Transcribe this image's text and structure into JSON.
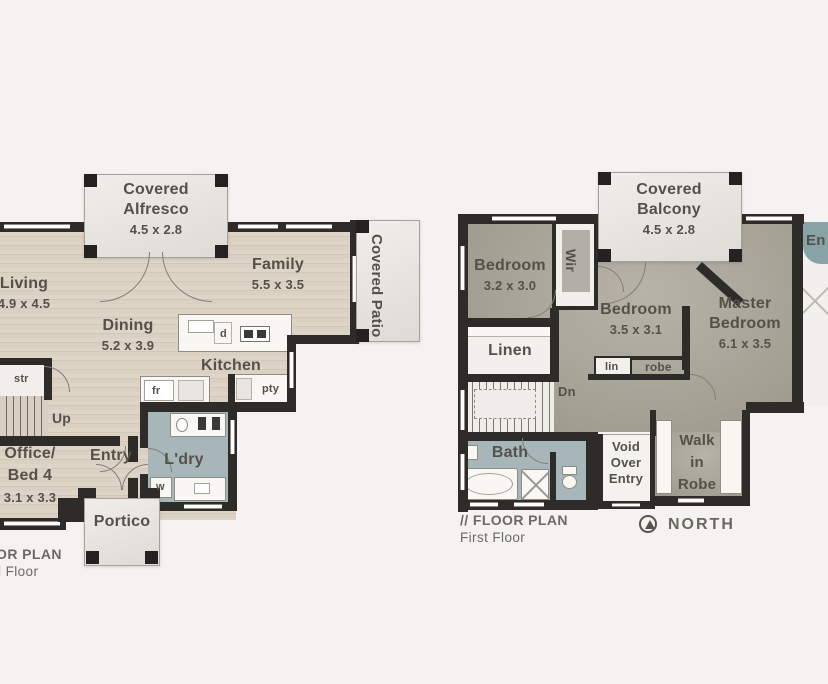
{
  "colors": {
    "background": "#f5f3f1",
    "wood_floor": "#d9cec1",
    "upper_floor": "#a5a195",
    "wet_area": "#a7b7b9",
    "walls": "#2d2c29",
    "covered_area": "#e9e7e2",
    "label_text": "#55514a"
  },
  "ground_floor": {
    "annotation": {
      "line1": "// FLOOR PLAN",
      "line2": "Ground Floor"
    },
    "alfresco": {
      "line1": "Covered",
      "line2": "Alfresco",
      "dims": "4.5 x 2.8"
    },
    "patio": {
      "label": "Covered Patio"
    },
    "living": {
      "name": "Living",
      "dims": "4.9 x 4.5"
    },
    "dining": {
      "name": "Dining",
      "dims": "5.2 x 3.9"
    },
    "family": {
      "name": "Family",
      "dims": "5.5 x 3.5"
    },
    "kitchen": {
      "name": "Kitchen",
      "dishwasher": "d",
      "fridge": "fr",
      "pantry": "pty"
    },
    "stairs": {
      "up": "Up",
      "store": "str"
    },
    "office": {
      "line1": "Office/",
      "line2": "Bed 4",
      "dims": "3.1 x 3.3"
    },
    "entry": {
      "name": "Entry"
    },
    "laundry": {
      "name": "L'dry",
      "washer": "w"
    },
    "portico": {
      "name": "Portico"
    }
  },
  "first_floor": {
    "annotation": {
      "line1": "// FLOOR PLAN",
      "line2": "First Floor"
    },
    "north_label": "NORTH",
    "balcony": {
      "line1": "Covered",
      "line2": "Balcony",
      "dims": "4.5 x 2.8"
    },
    "bedroom2": {
      "name": "Bedroom",
      "dims": "3.2 x 3.0"
    },
    "bedroom3": {
      "name": "Bedroom",
      "dims": "3.5 x 3.1"
    },
    "master": {
      "line1": "Master",
      "line2": "Bedroom",
      "dims": "6.1 x 3.5"
    },
    "wir": {
      "name": "Wir"
    },
    "linen": {
      "name": "Linen"
    },
    "stairs": {
      "dn": "Dn"
    },
    "lin": "lin",
    "robe": "robe",
    "bath": {
      "name": "Bath"
    },
    "void": {
      "line1": "Void",
      "line2": "Over",
      "line3": "Entry"
    },
    "walk_in_robe": {
      "line1": "Walk",
      "line2": "in",
      "line3": "Robe"
    },
    "ensuite": {
      "partial": "En"
    }
  }
}
